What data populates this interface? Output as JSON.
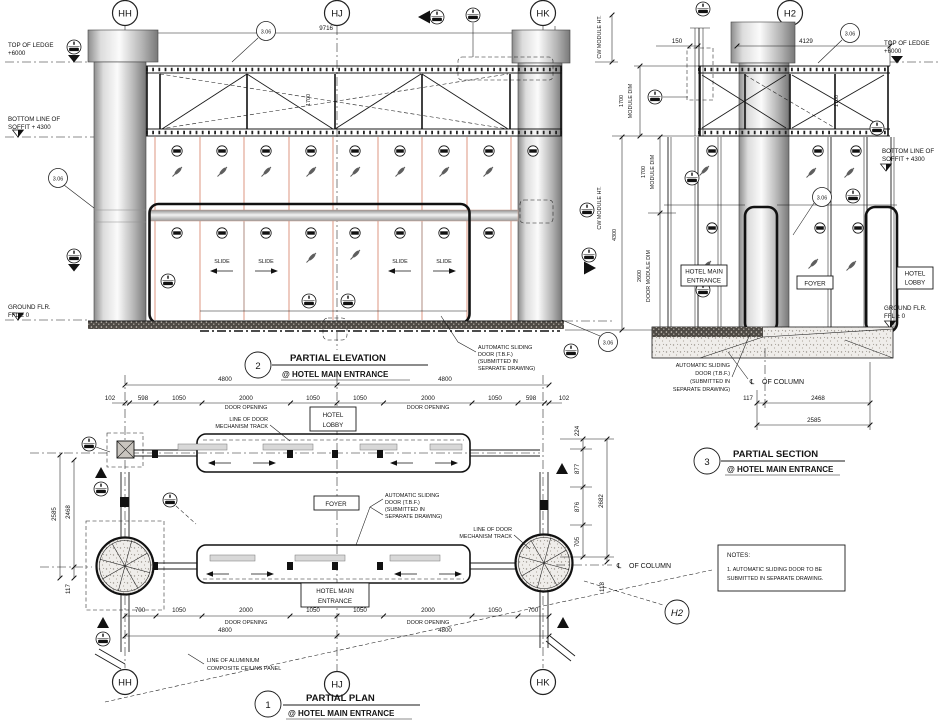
{
  "grid": {
    "hh": "HH",
    "hj": "HJ",
    "hk": "HK",
    "h2": "H2"
  },
  "titles": {
    "plan": {
      "num": "1",
      "name": "PARTIAL PLAN",
      "at": "@ HOTEL MAIN ENTRANCE"
    },
    "elevation": {
      "num": "2",
      "name": "PARTIAL ELEVATION",
      "at": "@ HOTEL MAIN ENTRANCE"
    },
    "section": {
      "num": "3",
      "name": "PARTIAL SECTION",
      "at": "@ HOTEL MAIN ENTRANCE"
    }
  },
  "levels": {
    "top_of_ledge_1": "TOP OF LEDGE",
    "top_of_ledge_2": "+6000",
    "soffit_1": "BOTTOM LINE OF",
    "soffit_2": "SOFFIT + 4300",
    "ground_1": "GROUND FLR.",
    "ground_2": "FFL ± 0"
  },
  "rooms": {
    "hotel_lobby_1": "HOTEL",
    "hotel_lobby_2": "LOBBY",
    "foyer": "FOYER",
    "hotel_main_1": "HOTEL MAIN",
    "hotel_main_2": "ENTRANCE"
  },
  "annotations": {
    "auto_door_1": "AUTOMATIC SL1DING",
    "auto_door_1_fix": "AUTOMATIC SLIDING",
    "auto_door_l1": "AUTOMATIC SLIDING",
    "auto_door_l2": "DOOR (T.B.F.)",
    "auto_door_l3": "(SUBMITTED IN",
    "auto_door_l4": "SEPARATE DRAWING)",
    "track_1": "LINE OF DOOR",
    "track_2": "MECHANISM TRACK",
    "ceiling_1": "LINE OF ALUMINIUM",
    "ceiling_2": "COMPOSITE CEILING PANEL",
    "cl_symbol": "℄",
    "of_column": "OF COLUMN",
    "slide": "SLIDE",
    "detail_ref": "3.06",
    "cw_module_ht": "CW MODULE HT.",
    "module_dim": "MODULE DIM",
    "door_module_dim": "DOOR MODULE DIM",
    "door_opening": "DOOR OPENING"
  },
  "dims": {
    "d9716": "9716",
    "d4129": "4129",
    "d150": "150",
    "d1700": "1700",
    "d4300": "4300",
    "d2600": "2600",
    "d4800": "4800",
    "d102": "102",
    "d598": "598",
    "d1050": "1050",
    "d2000": "2000",
    "d700": "700",
    "d117": "117",
    "d2468": "2468",
    "d2585": "2585",
    "d224": "224",
    "d877": "877",
    "d876": "876",
    "d705": "705",
    "d118": "118",
    "d2682": "2682"
  },
  "notes": {
    "heading": "NOTES:",
    "line1": "1. AUTOMATIC SLIDING DOOR TO BE",
    "line2": "SUBMITTED IN SEPARATE DRAWING."
  },
  "colors": {
    "mullion_accent": "#dfa08d",
    "line": "#1a1a1a",
    "concrete": "#efedea"
  }
}
